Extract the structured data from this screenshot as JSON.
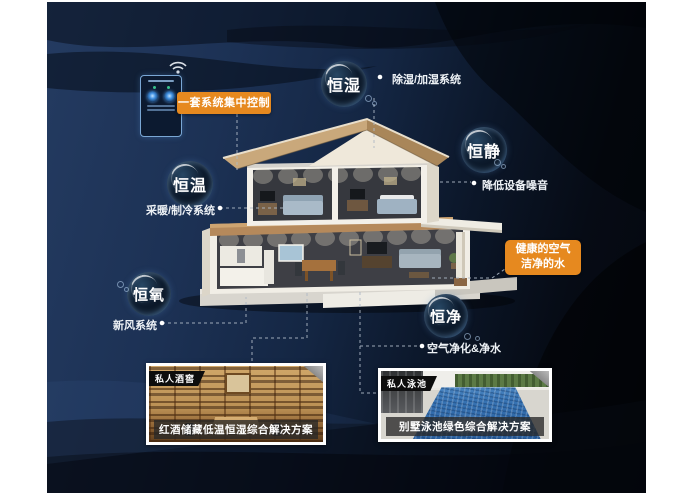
{
  "poster": {
    "control_panel": {
      "label": "一套系统集中控制"
    },
    "healthy_box": {
      "line1": "健康的空气",
      "line2": "洁净的水"
    },
    "bubbles": {
      "hengshi": {
        "label": "恒湿",
        "note": "除湿/加湿系统"
      },
      "hengjing": {
        "label": "恒静",
        "note": "降低设备噪音"
      },
      "hengwen": {
        "label": "恒温",
        "note": "采暖/制冷系统"
      },
      "hengyang": {
        "label": "恒氧",
        "note": "新风系统"
      },
      "hengjing2": {
        "label": "恒净",
        "note": "空气净化&净水"
      }
    },
    "cards": {
      "wine": {
        "tag": "私人酒窖",
        "caption": "红酒储藏低温恒湿综合解决方案"
      },
      "pool": {
        "tag": "私人泳池",
        "caption": "别墅泳池绿色综合解决方案"
      }
    },
    "icons": {
      "wifi": "wifi-icon",
      "panel": "smart-control-panel-icon"
    },
    "colors": {
      "accent_orange": "#e6891f",
      "bg_navy": "#1c3154",
      "bg_black": "#04070d",
      "bubble_rim": "#7fb0dc",
      "roof_tan": "#c9a87b",
      "wall_white": "#f2efe8"
    }
  }
}
